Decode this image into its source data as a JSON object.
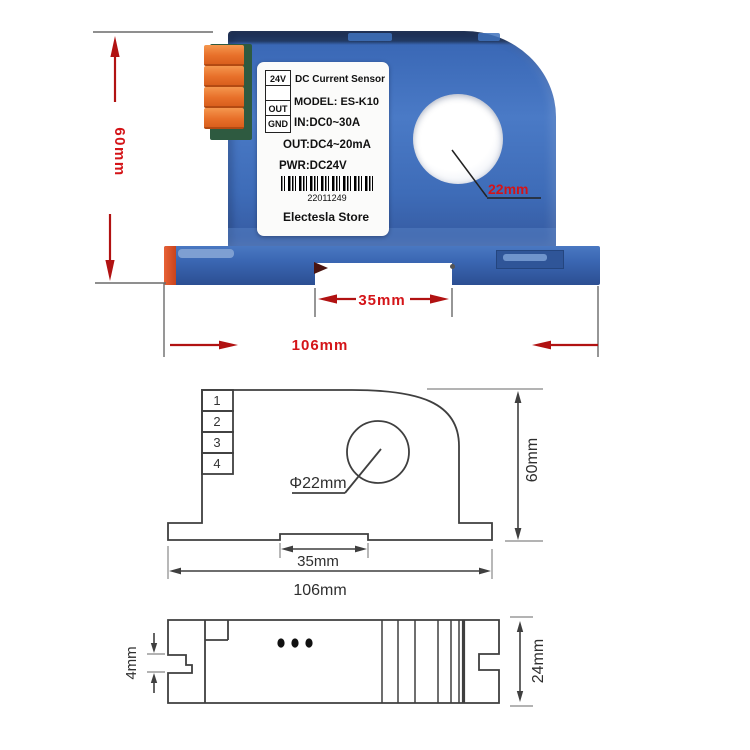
{
  "colors": {
    "dimension_text_red": "#d41418",
    "dimension_arrow_red": "#b11212",
    "body_blue": "#3e6cb8",
    "terminal_orange": "#e8702a",
    "drawing_line_gray": "#3f3f3f"
  },
  "photo": {
    "label": {
      "pins": [
        "24V",
        "",
        "OUT",
        "GND"
      ],
      "title": "DC Current Sensor",
      "model": "MODEL: ES-K10",
      "input": "IN:DC0~30A",
      "output": "OUT:DC4~20mA",
      "power": "PWR:DC24V",
      "serial": "22011249",
      "store": "Electesla Store"
    },
    "dims": {
      "height": "60mm",
      "hole": "22mm",
      "slot": "35mm",
      "width": "106mm"
    }
  },
  "front_drawing": {
    "terminals": [
      "1",
      "2",
      "3",
      "4"
    ],
    "dims": {
      "hole": "Φ22mm",
      "height": "60mm",
      "slot": "35mm",
      "width": "106mm"
    }
  },
  "top_drawing": {
    "dims": {
      "notch": "4mm",
      "depth": "24mm"
    }
  }
}
